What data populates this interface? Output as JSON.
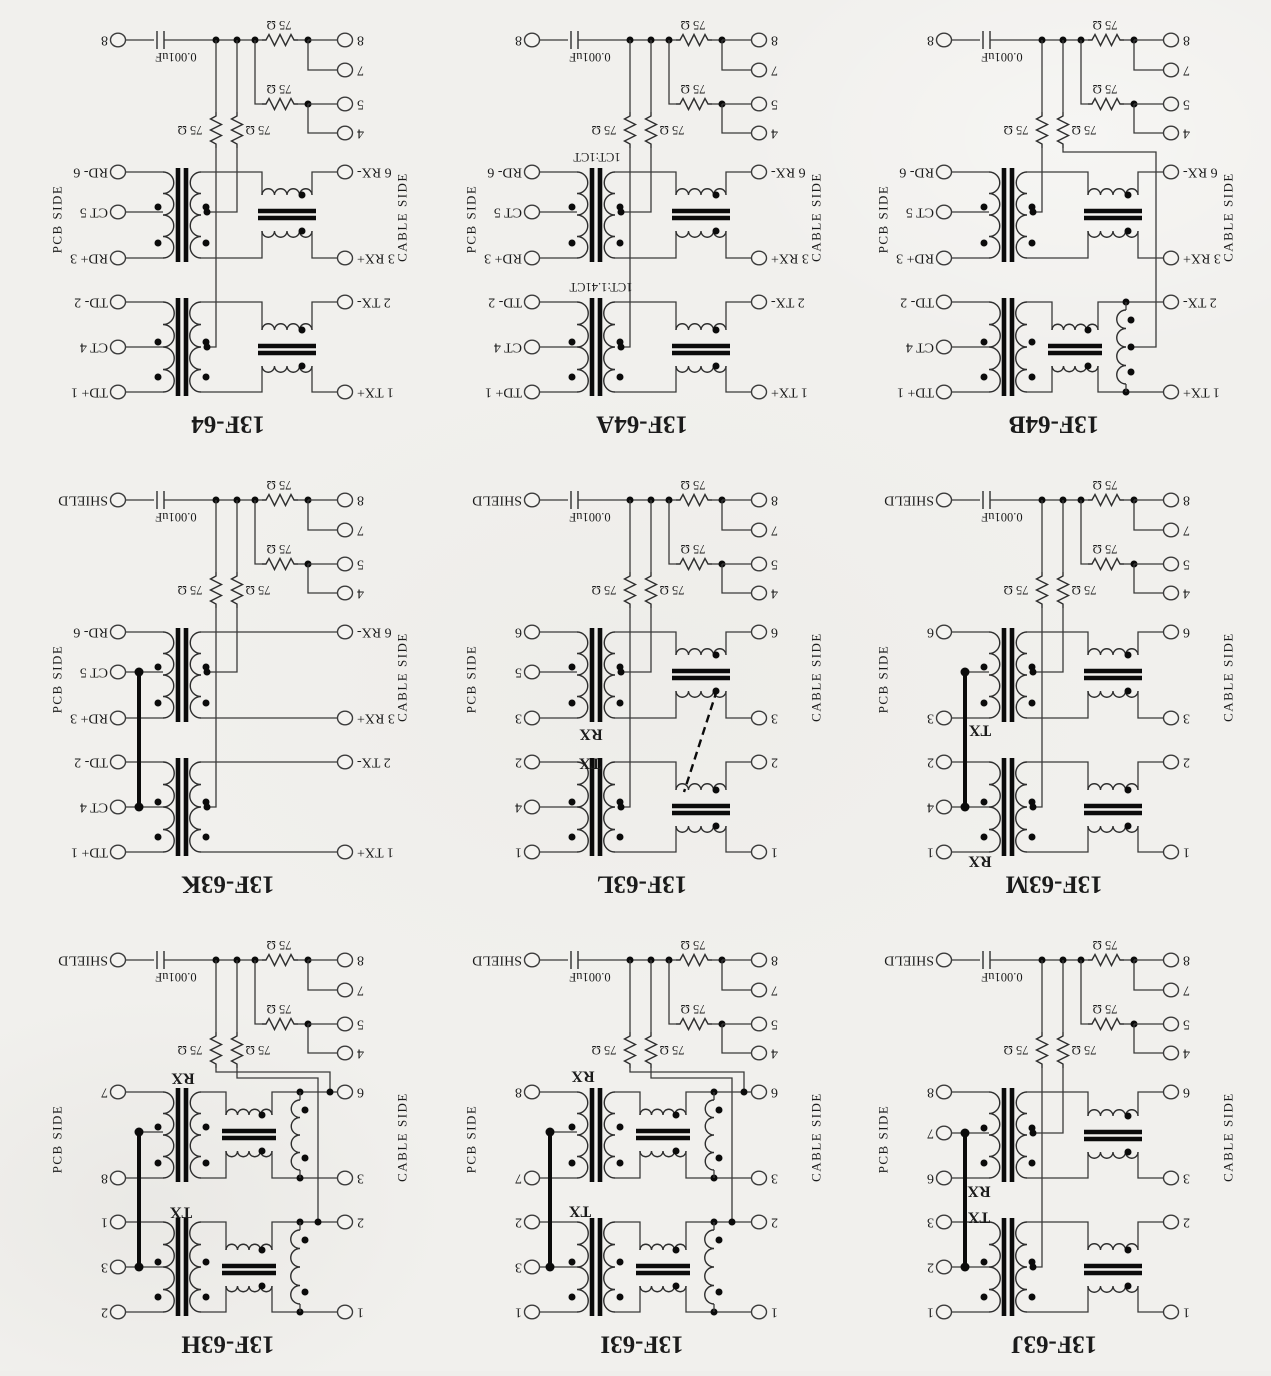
{
  "page": {
    "background": "#f1f0ed",
    "ink": "#3a3a3a",
    "dark_ink": "#0b0b0b",
    "orientation_note": "scanned page rotated 180 degrees"
  },
  "common": {
    "capacitor_label": "0.001uF",
    "resistor_label": "75 Ω",
    "pcb_side_label": "PCB SIDE",
    "cable_side_label": "CABLE SIDE",
    "corner_pin_labels": [
      "8",
      "7",
      "5",
      "4"
    ]
  },
  "cells": [
    {
      "title": "13F-64",
      "shield_pin_label": "8",
      "pcb_pins": [
        {
          "label": "RD- 6",
          "y": 172
        },
        {
          "label": "CT 5",
          "y": 212
        },
        {
          "label": "RD+ 3",
          "y": 258
        },
        {
          "label": "TD- 2",
          "y": 302
        },
        {
          "label": "CT 4",
          "y": 347
        },
        {
          "label": "TD+ 1",
          "y": 392
        }
      ],
      "cable_pins": [
        {
          "label": "6 RX-",
          "y": 172
        },
        {
          "label": "3 RX+",
          "y": 258
        },
        {
          "label": "2 TX-",
          "y": 302
        },
        {
          "label": "1 TX+",
          "y": 392
        }
      ],
      "channels": [
        {
          "y1": 172,
          "y2": 258,
          "ct": 212,
          "ct_pin": true,
          "choke": "std",
          "autotx": false
        },
        {
          "y1": 302,
          "y2": 392,
          "ct": 347,
          "ct_pin": true,
          "choke": "std",
          "autotx": false
        }
      ],
      "notes": [],
      "thick_link": null,
      "dashed_link": null,
      "rv_mode": "ct"
    },
    {
      "title": "13F-64A",
      "shield_pin_label": "8",
      "pcb_pins": [
        {
          "label": "RD- 6",
          "y": 172
        },
        {
          "label": "CT 5",
          "y": 212
        },
        {
          "label": "RD+ 3",
          "y": 258
        },
        {
          "label": "TD- 2",
          "y": 302
        },
        {
          "label": "CT 4",
          "y": 347
        },
        {
          "label": "TD+ 1",
          "y": 392
        }
      ],
      "cable_pins": [
        {
          "label": "6 RX-",
          "y": 172
        },
        {
          "label": "3 RX+",
          "y": 258
        },
        {
          "label": "2 TX-",
          "y": 302
        },
        {
          "label": "1 TX+",
          "y": 392
        }
      ],
      "channels": [
        {
          "y1": 172,
          "y2": 258,
          "ct": 212,
          "ct_pin": true,
          "choke": "std",
          "autotx": false
        },
        {
          "y1": 302,
          "y2": 392,
          "ct": 347,
          "ct_pin": true,
          "choke": "std",
          "autotx": false
        }
      ],
      "notes": [
        {
          "text": "1CT:1CT",
          "x": 183,
          "y": 157,
          "size": 12.5
        },
        {
          "text": "1CT:1.41CT",
          "x": 187,
          "y": 287,
          "size": 12.5
        }
      ],
      "thick_link": null,
      "dashed_link": null,
      "rv_mode": "ct"
    },
    {
      "title": "13F-64B",
      "shield_pin_label": "8",
      "pcb_pins": [
        {
          "label": "RD- 6",
          "y": 172
        },
        {
          "label": "CT 5",
          "y": 212
        },
        {
          "label": "RD+ 3",
          "y": 258
        },
        {
          "label": "TD- 2",
          "y": 302
        },
        {
          "label": "CT 4",
          "y": 347
        },
        {
          "label": "TD+ 1",
          "y": 392
        }
      ],
      "cable_pins": [
        {
          "label": "6 RX-",
          "y": 172
        },
        {
          "label": "3 RX+",
          "y": 258
        },
        {
          "label": "2 TX-",
          "y": 302
        },
        {
          "label": "1 TX+",
          "y": 392
        }
      ],
      "channels": [
        {
          "y1": 172,
          "y2": 258,
          "ct": 212,
          "ct_pin": true,
          "choke": "std",
          "autotx": false
        },
        {
          "y1": 302,
          "y2": 392,
          "ct": 347,
          "ct_pin": true,
          "choke": "auto",
          "autotx": true
        }
      ],
      "notes": [],
      "thick_link": null,
      "dashed_link": null,
      "rv_mode": "mixed"
    },
    {
      "title": "13F-63K",
      "shield_pin_label": "SHIELD",
      "pcb_pins": [
        {
          "label": "RD- 6",
          "y": 172
        },
        {
          "label": "CT 5",
          "y": 212
        },
        {
          "label": "RD+ 3",
          "y": 258
        },
        {
          "label": "TD- 2",
          "y": 302
        },
        {
          "label": "CT 4",
          "y": 347
        },
        {
          "label": "TD+ 1",
          "y": 392
        }
      ],
      "cable_pins": [
        {
          "label": "6 RX-",
          "y": 172
        },
        {
          "label": "3 RX+",
          "y": 258
        },
        {
          "label": "2 TX-",
          "y": 302
        },
        {
          "label": "1 TX+",
          "y": 392
        }
      ],
      "channels": [
        {
          "y1": 172,
          "y2": 258,
          "ct": 212,
          "ct_pin": true,
          "choke": "none",
          "autotx": false
        },
        {
          "y1": 302,
          "y2": 392,
          "ct": 347,
          "ct_pin": true,
          "choke": "none",
          "autotx": false
        }
      ],
      "notes": [],
      "thick_link": {
        "x": 139,
        "y1": 212,
        "y2": 347
      },
      "dashed_link": null,
      "rv_mode": "ct"
    },
    {
      "title": "13F-63L",
      "shield_pin_label": "SHIELD",
      "pcb_pins": [
        {
          "label": "6",
          "y": 172
        },
        {
          "label": "5",
          "y": 212
        },
        {
          "label": "3",
          "y": 258
        },
        {
          "label": "2",
          "y": 302
        },
        {
          "label": "4",
          "y": 347
        },
        {
          "label": "1",
          "y": 392
        }
      ],
      "cable_pins": [
        {
          "label": "6",
          "y": 172
        },
        {
          "label": "3",
          "y": 258
        },
        {
          "label": "2",
          "y": 302
        },
        {
          "label": "1",
          "y": 392
        }
      ],
      "channels": [
        {
          "y1": 172,
          "y2": 258,
          "ct": 212,
          "ct_pin": true,
          "choke": "std",
          "autotx": false
        },
        {
          "y1": 302,
          "y2": 392,
          "ct": 347,
          "ct_pin": true,
          "choke": "std",
          "autotx": false
        }
      ],
      "notes": [
        {
          "text": "RX",
          "x": 177,
          "y": 274,
          "size": 16,
          "bold": true
        },
        {
          "text": "TX",
          "x": 176,
          "y": 303,
          "size": 16,
          "bold": true
        }
      ],
      "thick_link": null,
      "dashed_link": {
        "x1": 303,
        "y1": 230,
        "x2": 270,
        "y2": 332
      },
      "rv_mode": "ct"
    },
    {
      "title": "13F-63M",
      "shield_pin_label": "SHIELD",
      "pcb_pins": [
        {
          "label": "6",
          "y": 172
        },
        {
          "label": "3",
          "y": 258
        },
        {
          "label": "2",
          "y": 302
        },
        {
          "label": "4",
          "y": 347
        },
        {
          "label": "1",
          "y": 392
        }
      ],
      "cable_pins": [
        {
          "label": "6",
          "y": 172
        },
        {
          "label": "3",
          "y": 258
        },
        {
          "label": "2",
          "y": 302
        },
        {
          "label": "1",
          "y": 392
        }
      ],
      "channels": [
        {
          "y1": 172,
          "y2": 258,
          "ct": 212,
          "ct_pin": false,
          "choke": "std",
          "autotx": false
        },
        {
          "y1": 302,
          "y2": 392,
          "ct": 347,
          "ct_pin": true,
          "choke": "std",
          "autotx": false
        }
      ],
      "notes": [
        {
          "text": "TX",
          "x": 154,
          "y": 270,
          "size": 16,
          "bold": true
        },
        {
          "text": "RX",
          "x": 154,
          "y": 401,
          "size": 16,
          "bold": true
        }
      ],
      "thick_link": {
        "x": 139,
        "y1": 212,
        "y2": 347
      },
      "dashed_link": null,
      "rv_mode": "ct"
    },
    {
      "title": "13F-63H",
      "shield_pin_label": "SHIELD",
      "pcb_pins": [
        {
          "label": "7",
          "y": 172
        },
        {
          "label": "8",
          "y": 258
        },
        {
          "label": "1",
          "y": 302
        },
        {
          "label": "3",
          "y": 347
        },
        {
          "label": "2",
          "y": 392
        }
      ],
      "cable_pins": [
        {
          "label": "6",
          "y": 172
        },
        {
          "label": "3",
          "y": 258
        },
        {
          "label": "2",
          "y": 302
        },
        {
          "label": "1",
          "y": 392
        }
      ],
      "channels": [
        {
          "y1": 172,
          "y2": 258,
          "ct": 212,
          "ct_pin": false,
          "choke": "auto",
          "autotx": true
        },
        {
          "y1": 302,
          "y2": 392,
          "ct": 347,
          "ct_pin": true,
          "choke": "auto",
          "autotx": true
        }
      ],
      "notes": [
        {
          "text": "RX",
          "x": 183,
          "y": 158,
          "size": 16,
          "bold": true
        },
        {
          "text": "TX",
          "x": 181,
          "y": 292,
          "size": 16,
          "bold": true
        }
      ],
      "thick_link": {
        "x": 139,
        "y1": 212,
        "y2": 347
      },
      "dashed_link": null,
      "rv_mode": "route"
    },
    {
      "title": "13F-63I",
      "shield_pin_label": "SHIELD",
      "pcb_pins": [
        {
          "label": "8",
          "y": 172
        },
        {
          "label": "7",
          "y": 258
        },
        {
          "label": "2",
          "y": 302
        },
        {
          "label": "3",
          "y": 347
        },
        {
          "label": "1",
          "y": 392
        }
      ],
      "cable_pins": [
        {
          "label": "6",
          "y": 172
        },
        {
          "label": "3",
          "y": 258
        },
        {
          "label": "2",
          "y": 302
        },
        {
          "label": "1",
          "y": 392
        }
      ],
      "channels": [
        {
          "y1": 172,
          "y2": 258,
          "ct": 212,
          "ct_pin": false,
          "choke": "auto",
          "autotx": true
        },
        {
          "y1": 302,
          "y2": 392,
          "ct": 347,
          "ct_pin": true,
          "choke": "auto",
          "autotx": true
        }
      ],
      "notes": [
        {
          "text": "RX",
          "x": 169,
          "y": 156,
          "size": 16,
          "bold": true
        },
        {
          "text": "TX",
          "x": 166,
          "y": 291,
          "size": 16,
          "bold": true
        }
      ],
      "thick_link": {
        "x": 136,
        "y1": 212,
        "y2": 347
      },
      "dashed_link": null,
      "rv_mode": "route"
    },
    {
      "title": "13F-63J",
      "shield_pin_label": "SHIELD",
      "pcb_pins": [
        {
          "label": "8",
          "y": 172
        },
        {
          "label": "7",
          "y": 213
        },
        {
          "label": "6",
          "y": 258
        },
        {
          "label": "3",
          "y": 302
        },
        {
          "label": "2",
          "y": 347
        },
        {
          "label": "1",
          "y": 392
        }
      ],
      "cable_pins": [
        {
          "label": "6",
          "y": 172
        },
        {
          "label": "3",
          "y": 258
        },
        {
          "label": "2",
          "y": 302
        },
        {
          "label": "1",
          "y": 392
        }
      ],
      "channels": [
        {
          "y1": 172,
          "y2": 258,
          "ct": 213,
          "ct_pin": true,
          "choke": "std",
          "autotx": false
        },
        {
          "y1": 302,
          "y2": 392,
          "ct": 347,
          "ct_pin": true,
          "choke": "std",
          "autotx": false
        }
      ],
      "notes": [
        {
          "text": "RX",
          "x": 153,
          "y": 271,
          "size": 16,
          "bold": true
        },
        {
          "text": "TX",
          "x": 153,
          "y": 297,
          "size": 16,
          "bold": true
        }
      ],
      "thick_link": {
        "x": 139,
        "y1": 213,
        "y2": 347
      },
      "dashed_link": null,
      "rv_mode": "ct"
    }
  ]
}
